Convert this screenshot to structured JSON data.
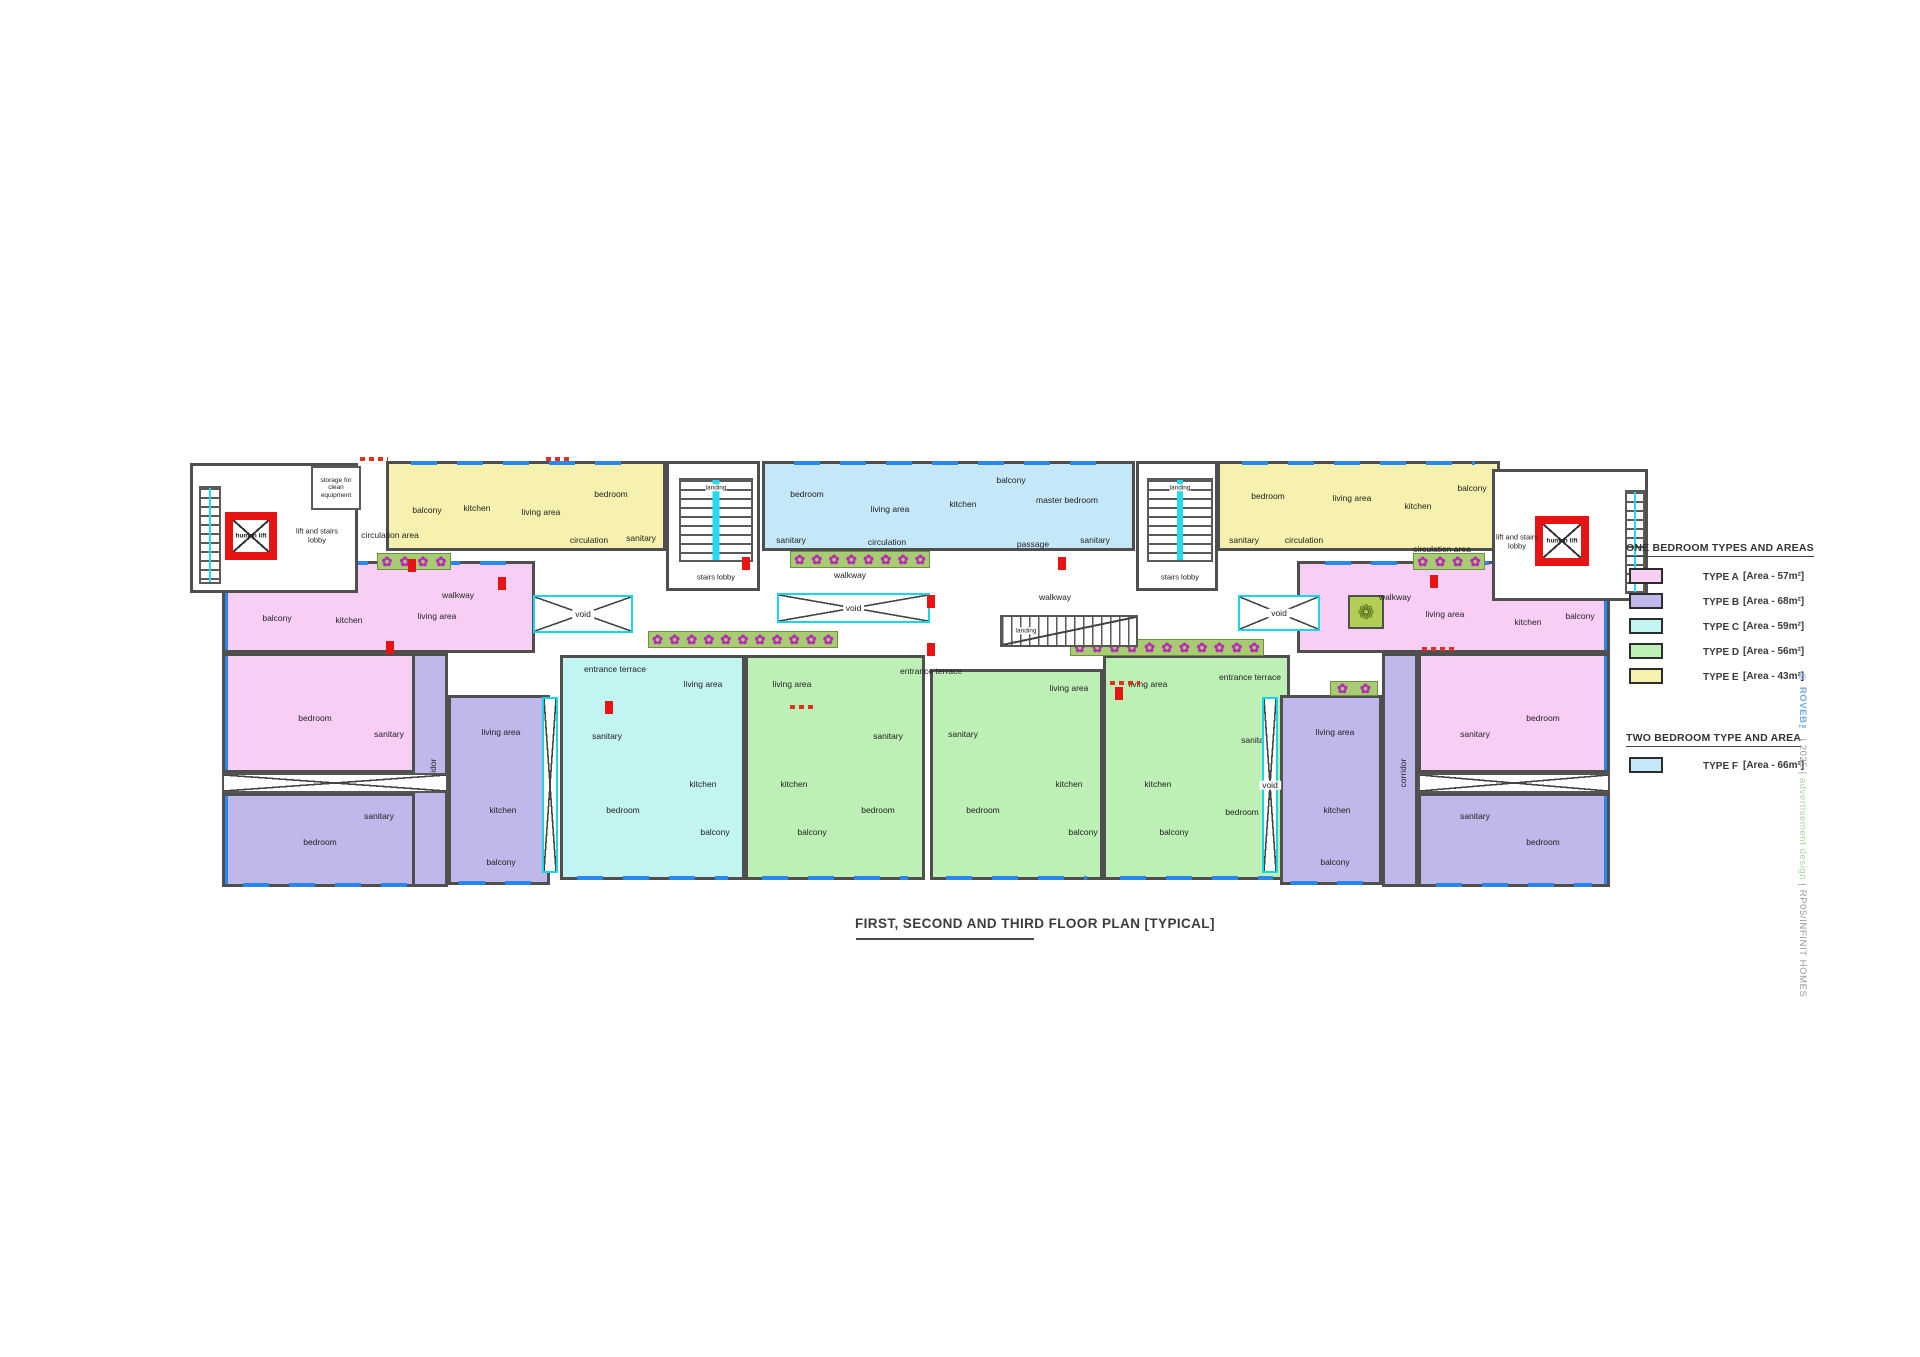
{
  "title": {
    "text": "FIRST, SECOND AND THIRD FLOOR PLAN [TYPICAL]"
  },
  "legend": {
    "one_bedroom_header": "ONE BEDROOM TYPES AND AREAS",
    "two_bedroom_header": "TWO BEDROOM TYPE AND AREA",
    "one_bedroom": [
      {
        "label": "TYPE A",
        "area": "[Area - 57m²]",
        "color": "#f9cef5"
      },
      {
        "label": "TYPE B",
        "area": "[Area - 68m²]",
        "color": "#beb9ea"
      },
      {
        "label": "TYPE C",
        "area": "[Area - 59m²]",
        "color": "#c2f4f1"
      },
      {
        "label": "TYPE D",
        "area": "[Area - 56m²]",
        "color": "#bdf0b4"
      },
      {
        "label": "TYPE E",
        "area": "[Area - 43m²]",
        "color": "#f6f1ae"
      }
    ],
    "two_bedroom": [
      {
        "label": "TYPE F",
        "area": "[Area - 66m²]",
        "color": "#c5e8f9"
      }
    ]
  },
  "watermark": {
    "copyright": "© ROVEB™",
    "sep1": " | ",
    "year": "2025",
    "sep2": " | ",
    "design": "advertisement design",
    "sep3": " | ",
    "project": "RP05/INFINIT HOMES"
  },
  "plan": {
    "colors": {
      "A": "#f9cef5",
      "B": "#beb9ea",
      "C": "#c2f4f1",
      "D": "#bdf0b4",
      "E": "#f6f1ae",
      "F": "#c5e8f9"
    },
    "units": [
      {
        "type": "E",
        "x": 196,
        "y": 6,
        "w": 280,
        "h": 90,
        "win": [
          "top"
        ],
        "rooms": [
          {
            "label": "balcony",
            "x": 38,
            "y": 46
          },
          {
            "label": "kitchen",
            "x": 88,
            "y": 44
          },
          {
            "label": "living area",
            "x": 152,
            "y": 48
          },
          {
            "label": "bedroom",
            "x": 222,
            "y": 30
          },
          {
            "label": "circulation",
            "x": 200,
            "y": 76
          },
          {
            "label": "sanitary",
            "x": 252,
            "y": 74
          }
        ]
      },
      {
        "type": "F",
        "x": 572,
        "y": 6,
        "w": 373,
        "h": 90,
        "win": [
          "top"
        ],
        "rooms": [
          {
            "label": "bedroom",
            "x": 42,
            "y": 30
          },
          {
            "label": "sanitary",
            "x": 26,
            "y": 76
          },
          {
            "label": "living area",
            "x": 125,
            "y": 45
          },
          {
            "label": "circulation",
            "x": 122,
            "y": 78
          },
          {
            "label": "kitchen",
            "x": 198,
            "y": 40
          },
          {
            "label": "passage",
            "x": 268,
            "y": 80
          },
          {
            "label": "balcony",
            "x": 246,
            "y": 16
          },
          {
            "label": "master bedroom",
            "x": 302,
            "y": 36
          },
          {
            "label": "sanitary",
            "x": 330,
            "y": 76
          }
        ]
      },
      {
        "type": "E",
        "x": 1027,
        "y": 6,
        "w": 283,
        "h": 90,
        "win": [
          "top"
        ],
        "rooms": [
          {
            "label": "bedroom",
            "x": 48,
            "y": 32
          },
          {
            "label": "sanitary",
            "x": 24,
            "y": 76
          },
          {
            "label": "circulation",
            "x": 84,
            "y": 76
          },
          {
            "label": "living area",
            "x": 132,
            "y": 34
          },
          {
            "label": "kitchen",
            "x": 198,
            "y": 42
          },
          {
            "label": "balcony",
            "x": 252,
            "y": 24
          }
        ]
      },
      {
        "type": "A",
        "x": 32,
        "y": 106,
        "w": 313,
        "h": 92,
        "win": [
          "top",
          "left"
        ],
        "rooms": [
          {
            "label": "balcony",
            "x": 52,
            "y": 54
          },
          {
            "label": "kitchen",
            "x": 124,
            "y": 56
          },
          {
            "label": "living area",
            "x": 212,
            "y": 52
          }
        ]
      },
      {
        "type": "A",
        "x": 32,
        "y": 198,
        "w": 226,
        "h": 120,
        "win": [
          "left"
        ],
        "rooms": [
          {
            "label": "bedroom",
            "x": 90,
            "y": 62
          },
          {
            "label": "sanitary",
            "x": 164,
            "y": 78
          }
        ]
      },
      {
        "type": "B",
        "x": 32,
        "y": 338,
        "w": 226,
        "h": 94,
        "win": [
          "bottom",
          "left"
        ],
        "rooms": [
          {
            "label": "sanitary",
            "x": 154,
            "y": 20
          },
          {
            "label": "bedroom",
            "x": 95,
            "y": 46
          }
        ]
      },
      {
        "type": "B",
        "x": 222,
        "y": 198,
        "w": 36,
        "h": 234,
        "win": [],
        "rooms": [
          {
            "label": "corridor",
            "x": 18,
            "y": 117,
            "rot": true
          }
        ]
      },
      {
        "type": "B",
        "x": 258,
        "y": 240,
        "w": 102,
        "h": 190,
        "win": [
          "bottom"
        ],
        "rooms": [
          {
            "label": "living area",
            "x": 50,
            "y": 34
          },
          {
            "label": "kitchen",
            "x": 52,
            "y": 112
          },
          {
            "label": "balcony",
            "x": 50,
            "y": 164
          }
        ]
      },
      {
        "type": "C",
        "x": 370,
        "y": 200,
        "w": 185,
        "h": 225,
        "win": [
          "bottom"
        ],
        "rooms": [
          {
            "label": "sanitary",
            "x": 44,
            "y": 78
          },
          {
            "label": "bedroom",
            "x": 60,
            "y": 152
          },
          {
            "label": "living area",
            "x": 140,
            "y": 26
          },
          {
            "label": "kitchen",
            "x": 140,
            "y": 126
          },
          {
            "label": "balcony",
            "x": 152,
            "y": 174
          }
        ]
      },
      {
        "type": "D",
        "x": 555,
        "y": 200,
        "w": 180,
        "h": 225,
        "win": [
          "bottom"
        ],
        "rooms": [
          {
            "label": "living area",
            "x": 44,
            "y": 26
          },
          {
            "label": "kitchen",
            "x": 46,
            "y": 126
          },
          {
            "label": "balcony",
            "x": 64,
            "y": 174
          },
          {
            "label": "sanitary",
            "x": 140,
            "y": 78
          },
          {
            "label": "bedroom",
            "x": 130,
            "y": 152
          }
        ]
      },
      {
        "type": "D",
        "x": 740,
        "y": 214,
        "w": 173,
        "h": 211,
        "win": [
          "bottom"
        ],
        "rooms": [
          {
            "label": "sanitary",
            "x": 30,
            "y": 62
          },
          {
            "label": "bedroom",
            "x": 50,
            "y": 138
          },
          {
            "label": "living area",
            "x": 136,
            "y": 16
          },
          {
            "label": "kitchen",
            "x": 136,
            "y": 112
          },
          {
            "label": "balcony",
            "x": 150,
            "y": 160
          }
        ]
      },
      {
        "type": "D",
        "x": 913,
        "y": 200,
        "w": 187,
        "h": 225,
        "win": [
          "bottom"
        ],
        "rooms": [
          {
            "label": "living area",
            "x": 42,
            "y": 26
          },
          {
            "label": "kitchen",
            "x": 52,
            "y": 126
          },
          {
            "label": "balcony",
            "x": 68,
            "y": 174
          },
          {
            "label": "sanitary",
            "x": 150,
            "y": 82
          },
          {
            "label": "bedroom",
            "x": 136,
            "y": 154
          }
        ]
      },
      {
        "type": "B",
        "x": 1090,
        "y": 240,
        "w": 102,
        "h": 190,
        "win": [
          "bottom"
        ],
        "rooms": [
          {
            "label": "living area",
            "x": 52,
            "y": 34
          },
          {
            "label": "kitchen",
            "x": 54,
            "y": 112
          },
          {
            "label": "balcony",
            "x": 52,
            "y": 164
          }
        ]
      },
      {
        "type": "B",
        "x": 1192,
        "y": 198,
        "w": 36,
        "h": 234,
        "win": [],
        "rooms": [
          {
            "label": "corridor",
            "x": 18,
            "y": 117,
            "rot": true
          }
        ]
      },
      {
        "type": "A",
        "x": 1228,
        "y": 198,
        "w": 192,
        "h": 120,
        "win": [
          "right"
        ],
        "rooms": [
          {
            "label": "sanitary",
            "x": 54,
            "y": 78
          },
          {
            "label": "bedroom",
            "x": 122,
            "y": 62
          }
        ]
      },
      {
        "type": "B",
        "x": 1228,
        "y": 338,
        "w": 192,
        "h": 94,
        "win": [
          "bottom",
          "right"
        ],
        "rooms": [
          {
            "label": "sanitary",
            "x": 54,
            "y": 20
          },
          {
            "label": "bedroom",
            "x": 122,
            "y": 46
          }
        ]
      },
      {
        "type": "A",
        "x": 1107,
        "y": 106,
        "w": 313,
        "h": 92,
        "win": [
          "top",
          "right"
        ],
        "rooms": [
          {
            "label": "living area",
            "x": 145,
            "y": 50
          },
          {
            "label": "kitchen",
            "x": 228,
            "y": 58
          },
          {
            "label": "balcony",
            "x": 280,
            "y": 52
          }
        ]
      }
    ],
    "lobbies": [
      {
        "name": "lift-stairs-lobby-left",
        "x": 0,
        "y": 8,
        "w": 168,
        "h": 130,
        "lift": {
          "x": 32,
          "y": 46,
          "w": 52,
          "h": 48,
          "label": "human lift"
        },
        "stairs": [
          {
            "x": 6,
            "y": 20,
            "w": 22,
            "h": 98
          }
        ],
        "sub": {
          "x": 118,
          "y": 0,
          "w": 50,
          "h": 44,
          "label": "storage for clean equipment"
        },
        "labels": [
          {
            "text": "lift and stairs lobby",
            "x": 124,
            "y": 70,
            "w": 62
          }
        ]
      },
      {
        "name": "stairs-lobby-1",
        "x": 476,
        "y": 6,
        "w": 94,
        "h": 130,
        "stairs": [
          {
            "x": 10,
            "y": 14,
            "w": 74,
            "h": 84
          }
        ],
        "landing": {
          "x": 47,
          "y": 24
        },
        "labels": [
          {
            "text": "stairs lobby",
            "x": 47,
            "y": 114,
            "w": 80
          }
        ]
      },
      {
        "name": "stairs-lobby-2",
        "x": 946,
        "y": 6,
        "w": 82,
        "h": 130,
        "stairs": [
          {
            "x": 8,
            "y": 14,
            "w": 66,
            "h": 84
          }
        ],
        "landing": {
          "x": 41,
          "y": 24
        },
        "labels": [
          {
            "text": "stairs lobby",
            "x": 41,
            "y": 114,
            "w": 78
          }
        ]
      },
      {
        "name": "lift-stairs-lobby-right",
        "x": 1302,
        "y": 14,
        "w": 156,
        "h": 132,
        "lift": {
          "x": 40,
          "y": 44,
          "w": 54,
          "h": 50,
          "label": "human lift"
        },
        "stairs": [
          {
            "x": 130,
            "y": 18,
            "w": 20,
            "h": 104
          }
        ],
        "labels": [
          {
            "text": "lift and stairs lobby",
            "x": 22,
            "y": 70,
            "w": 58
          }
        ]
      }
    ],
    "voids": [
      {
        "x": 343,
        "y": 140,
        "w": 100,
        "h": 38,
        "label": "void"
      },
      {
        "x": 587,
        "y": 138,
        "w": 153,
        "h": 30,
        "label": "void"
      },
      {
        "x": 1048,
        "y": 140,
        "w": 82,
        "h": 36,
        "label": "void"
      },
      {
        "x": 352,
        "y": 242,
        "w": 16,
        "h": 176,
        "label": ""
      },
      {
        "x": 1072,
        "y": 242,
        "w": 16,
        "h": 176,
        "label": "void"
      }
    ],
    "xstrips": [
      {
        "x": 32,
        "y": 318,
        "w": 226,
        "h": 20
      },
      {
        "x": 1228,
        "y": 318,
        "w": 192,
        "h": 20
      }
    ],
    "planters": [
      {
        "x": 187,
        "y": 98,
        "w": 74,
        "h": 17,
        "flowers": 4
      },
      {
        "x": 458,
        "y": 176,
        "w": 190,
        "h": 17,
        "flowers": 11
      },
      {
        "x": 600,
        "y": 96,
        "w": 140,
        "h": 17,
        "flowers": 8
      },
      {
        "x": 1223,
        "y": 98,
        "w": 72,
        "h": 17,
        "flowers": 4
      },
      {
        "x": 1140,
        "y": 226,
        "w": 48,
        "h": 15,
        "flowers": 2
      },
      {
        "x": 880,
        "y": 184,
        "w": 194,
        "h": 17,
        "flowers": 11
      }
    ],
    "leaf_planter": {
      "x": 1158,
      "y": 140,
      "w": 36,
      "h": 34,
      "glyph": "❁"
    },
    "ext_stair": {
      "x": 810,
      "y": 160,
      "w": 138,
      "h": 32,
      "label": "landing"
    },
    "labels": [
      {
        "text": "circulation area",
        "x": 200,
        "y": 80
      },
      {
        "text": "circulation area",
        "x": 1252,
        "y": 94
      },
      {
        "text": "walkway",
        "x": 268,
        "y": 140
      },
      {
        "text": "walkway",
        "x": 660,
        "y": 120
      },
      {
        "text": "walkway",
        "x": 865,
        "y": 142
      },
      {
        "text": "walkway",
        "x": 1205,
        "y": 142
      },
      {
        "text": "entrance terrace",
        "x": 425,
        "y": 214
      },
      {
        "text": "entrance terrace",
        "x": 741,
        "y": 216
      },
      {
        "text": "entrance terrace",
        "x": 1060,
        "y": 222
      }
    ],
    "red_markers": [
      [
        218,
        104
      ],
      [
        308,
        122
      ],
      [
        737,
        140
      ],
      [
        737,
        188
      ],
      [
        552,
        102
      ],
      [
        868,
        102
      ],
      [
        196,
        186
      ],
      [
        1240,
        120
      ],
      [
        925,
        232
      ],
      [
        415,
        246
      ]
    ],
    "red_dashes": [
      [
        170,
        2,
        28
      ],
      [
        356,
        2,
        26
      ],
      [
        920,
        226,
        30
      ],
      [
        1232,
        192,
        32
      ],
      [
        600,
        250,
        26
      ]
    ]
  }
}
